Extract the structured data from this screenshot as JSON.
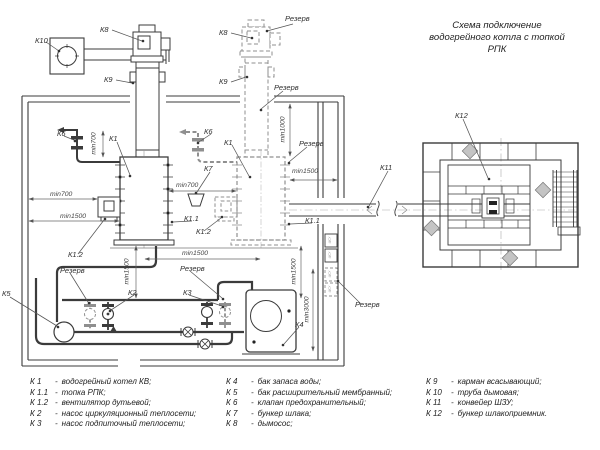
{
  "title": {
    "line1": "Схема подключение",
    "line2": "водогрейного котла с топкой",
    "line3": "РПК"
  },
  "diagram": {
    "labels": {
      "k10": "К10",
      "k8_1": "К8",
      "k8_2": "К8",
      "k9_1": "К9",
      "k9_2": "К9",
      "k6_1": "К6",
      "k6_2": "К6",
      "k1_a": "К1",
      "k1_b": "К1",
      "k7": "К7",
      "k11": "К11",
      "k12": "К12",
      "k1_1_a": "К1.1",
      "k1_1_b": "К1.1",
      "k1_2_a": "К1.2",
      "k1_2_b": "К1.2",
      "k2": "К2",
      "k3": "К3",
      "k4": "К4",
      "k5": "К5",
      "reserve1": "Резерв",
      "reserve2": "Резерв",
      "reserve3": "Резерв",
      "reserve4": "Резерв",
      "reserve5": "Резерв",
      "reserve6": "Резерв",
      "cabinet": "ЩСУ"
    },
    "dimensions": {
      "min700_v": "min700",
      "min700_left": "min700",
      "min1500_left": "min1500",
      "min700_mid": "min700",
      "min1500_mid": "min1500",
      "min1500_v_left": "min1500",
      "min1000_v": "min1000",
      "min1500_v_right": "min1500",
      "min3000_v": "min3000",
      "min1500_right": "min1500"
    },
    "colors": {
      "line_dark": "#3b3b3b",
      "line_reserve": "#8f8f8f",
      "line_dim": "#666666"
    }
  },
  "legend": {
    "sep": "-",
    "items": [
      {
        "id": "К 1",
        "desc": "водогрейный котел КВ;"
      },
      {
        "id": "К 1.1",
        "desc": "топка РПК;"
      },
      {
        "id": "К 1.2",
        "desc": "вентилятор дутьевой;"
      },
      {
        "id": "К 2",
        "desc": "насос циркуляционный теплосети;"
      },
      {
        "id": "К 3",
        "desc": "насос подпиточный теплосети;"
      },
      {
        "id": "К 4",
        "desc": "бак запаса воды;"
      },
      {
        "id": "К 5",
        "desc": "бак расширительный мембранный;"
      },
      {
        "id": "К 6",
        "desc": "клапан предохранительный;"
      },
      {
        "id": "К 7",
        "desc": "бункер шлака;"
      },
      {
        "id": "К 8",
        "desc": "дымосос;"
      },
      {
        "id": "К 9",
        "desc": "карман всасывающий;"
      },
      {
        "id": "К 10",
        "desc": "труба дымовая;"
      },
      {
        "id": "К 11",
        "desc": "конвейер ШЗУ;"
      },
      {
        "id": "К 12",
        "desc": "бункер шлакоприемник."
      }
    ]
  }
}
